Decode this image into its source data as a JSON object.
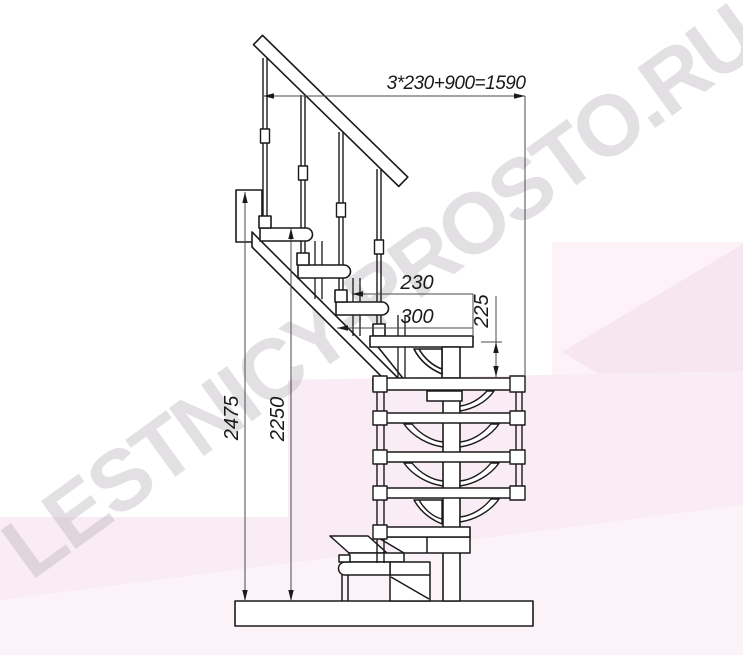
{
  "watermark": "LESTNICY-PROSTO.RU",
  "dims": {
    "run_total": "3*230+900=1590",
    "run_step": "230",
    "tread_depth": "300",
    "rise_module": "225",
    "height_total": "2475",
    "height_upper": "2250"
  },
  "colors": {
    "line": "#1a1a1a",
    "dim_line": "#4a4a4a",
    "background": "#ffffff",
    "pink_panel": "#fdf2f8",
    "pink_band": "#f9ecf4",
    "pink_wedge": "#f7e5ef",
    "watermark_gray": "rgba(168,158,170,0.32)"
  }
}
